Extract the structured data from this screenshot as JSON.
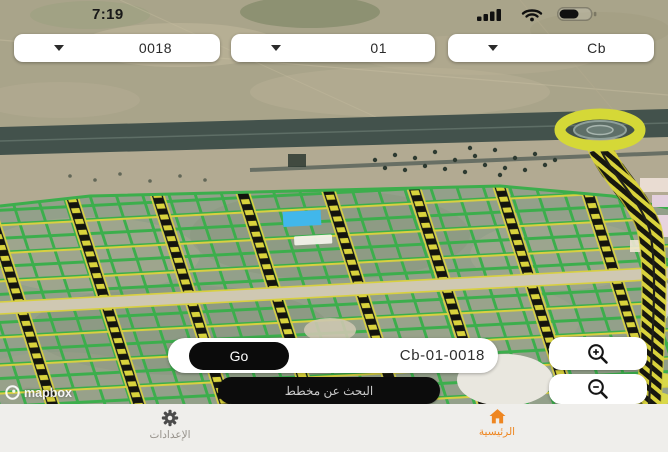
{
  "status_bar": {
    "time": "7:19"
  },
  "selectors": [
    {
      "name": "plot-number",
      "value": "0018"
    },
    {
      "name": "block-number",
      "value": "01"
    },
    {
      "name": "district-code",
      "value": "Cb"
    }
  ],
  "search_bar": {
    "go_label": "Go",
    "query": "Cb-01-0018"
  },
  "plan_search_button_label": "البحث عن مخطط",
  "map": {
    "attribution": "mapbox"
  },
  "bottom_nav": {
    "settings_label": "الإعدادات",
    "home_label": "الرئيسية"
  },
  "colors": {
    "accent": "#EE8621",
    "parcel_highlight": "#41B7EB",
    "parcel_outline": "#3CAE4C",
    "road_yellow": "#D8D040"
  }
}
